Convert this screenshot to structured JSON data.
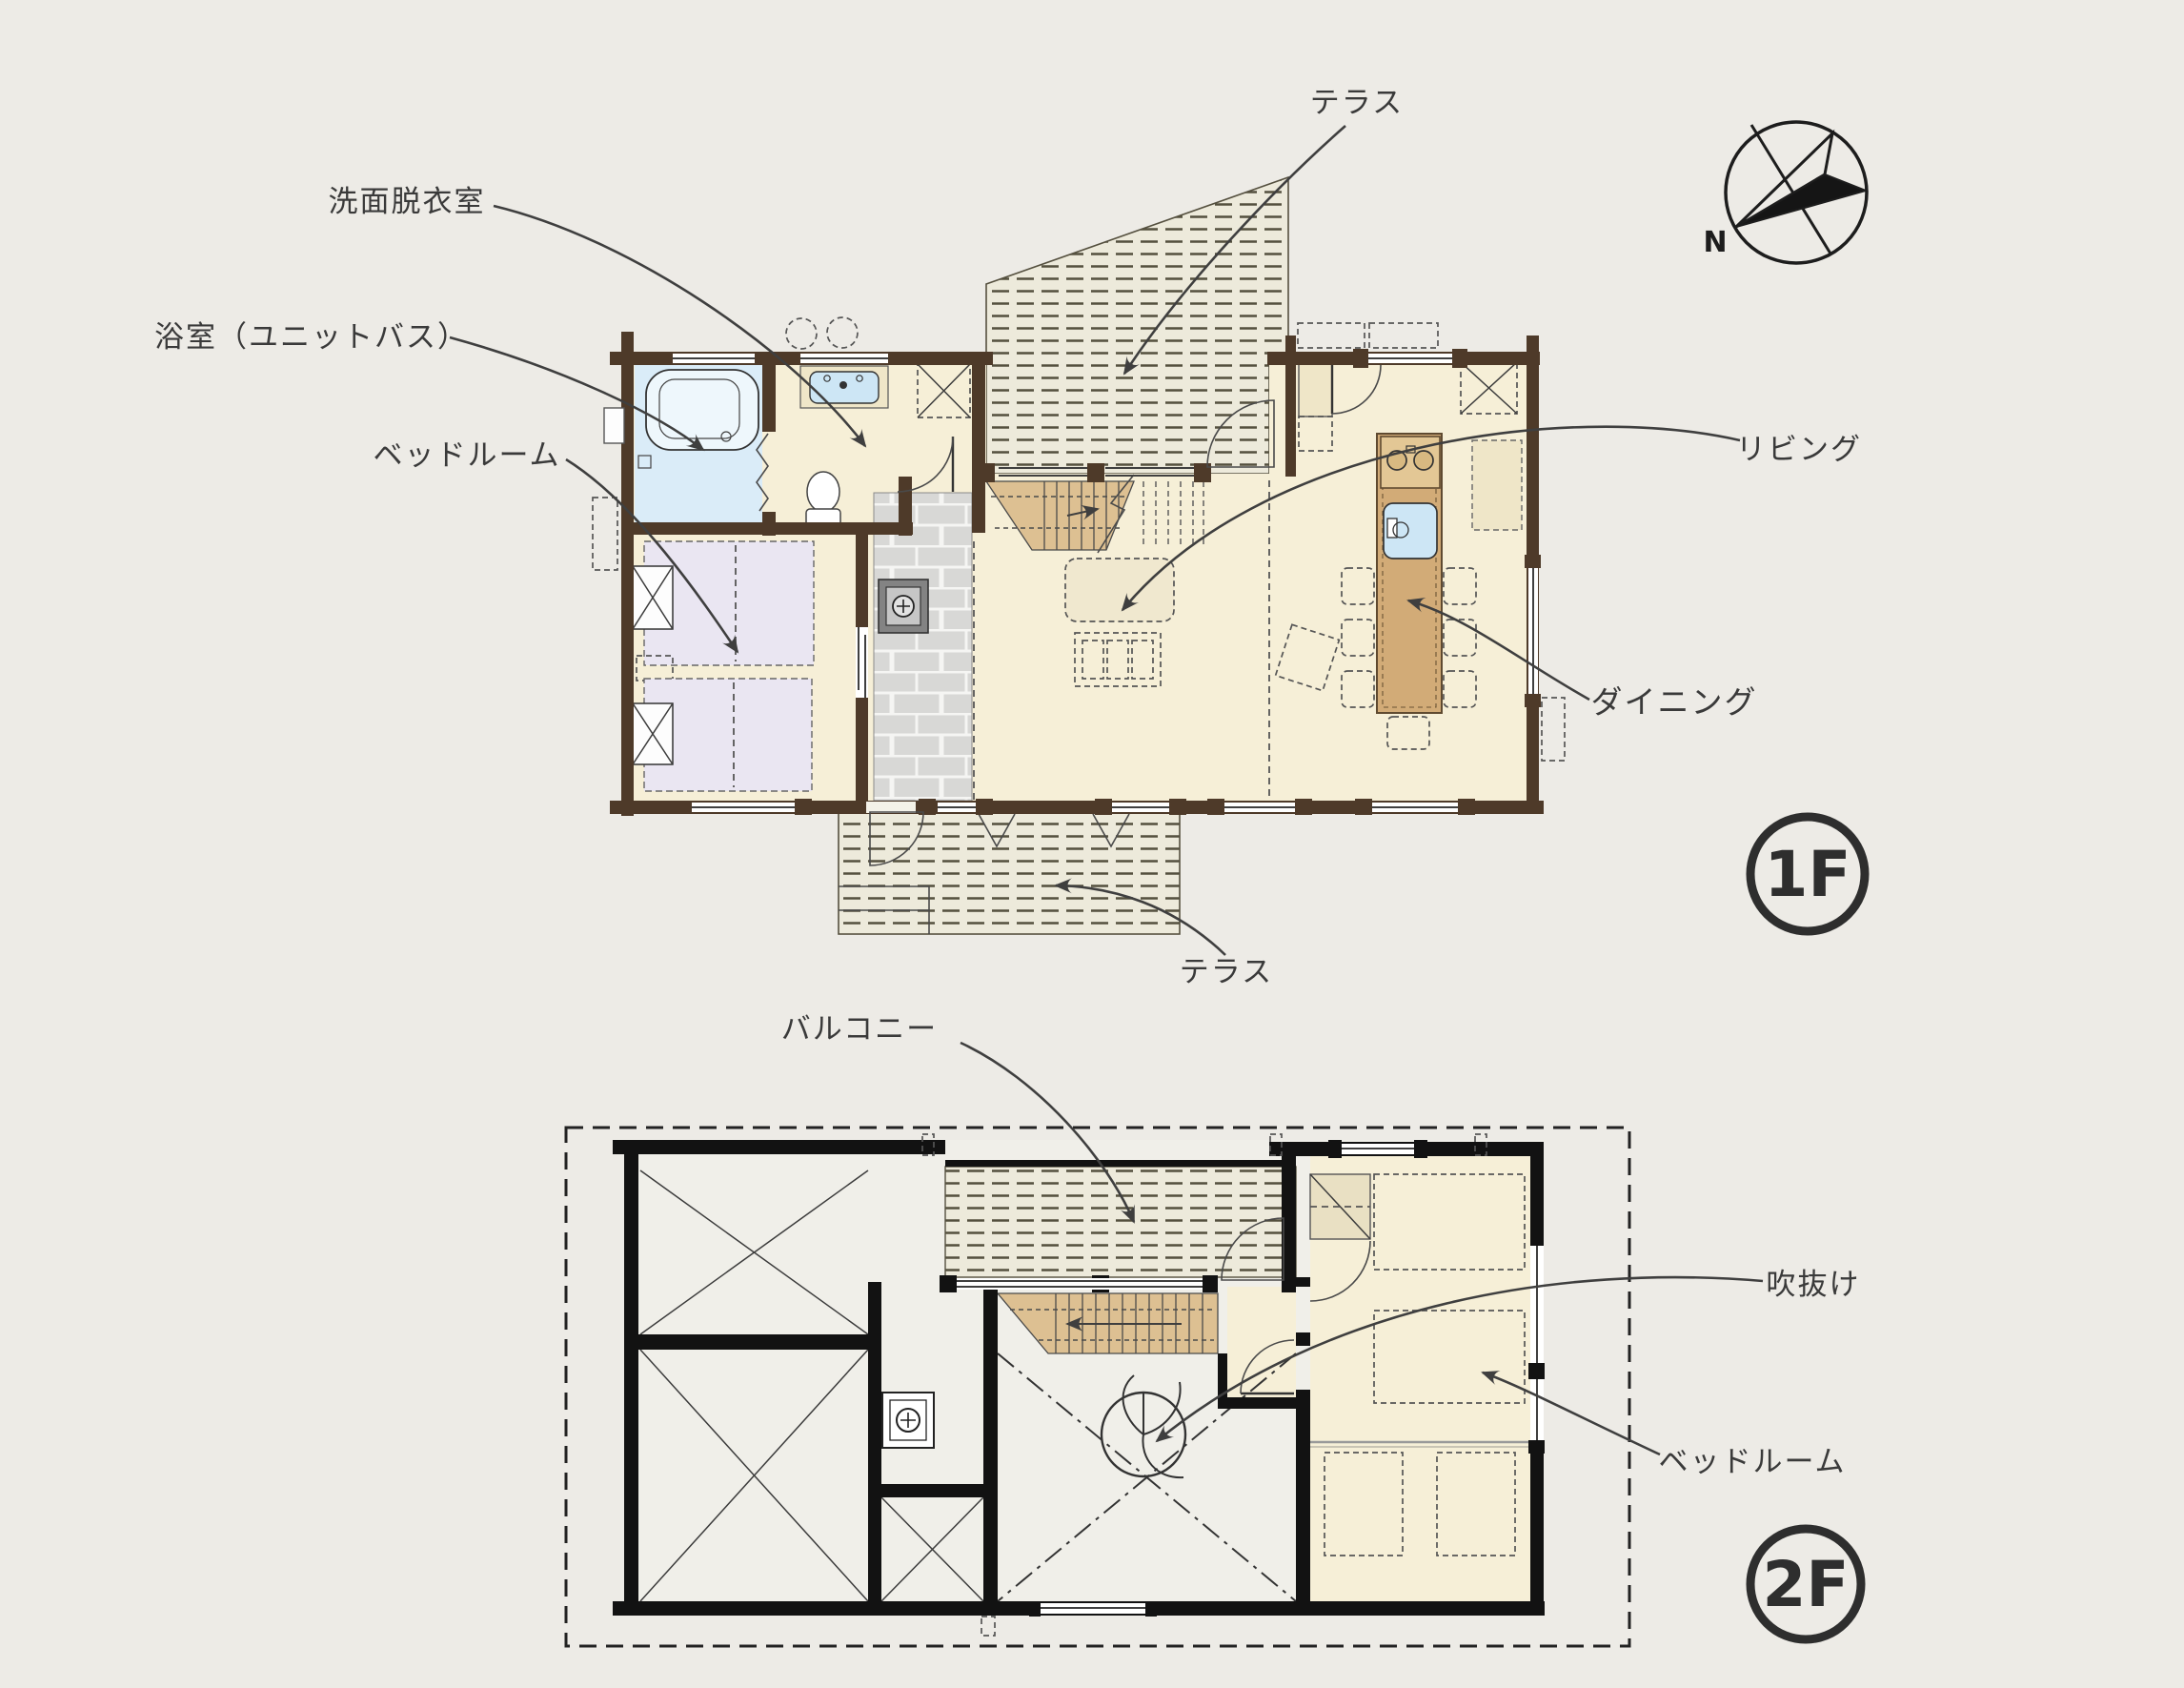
{
  "colors": {
    "background": "#edebe6",
    "ink": "#3a3a3a",
    "wall1": "#4e3a29",
    "wall2": "#121212",
    "floor": "#f6efd7",
    "interior2f": "#f0efe9",
    "bath": "#daecf8",
    "deck": "#edeadb",
    "deckline": "#54503e",
    "tile": "#d8d8d6",
    "stairs": "#ddc092",
    "wood": "#d2ab77",
    "sink": "#cde6f5",
    "linen": "#eae6f2",
    "beige": "#efe6c8"
  },
  "floor1": {
    "badge": "1F",
    "labels": {
      "terrace_top": "テラス",
      "washroom": "洗面脱衣室",
      "bathroom": "浴室（ユニットバス）",
      "bedroom": "ベッドルーム",
      "living": "リビング",
      "dining": "ダイニング",
      "terrace_bottom": "テラス"
    }
  },
  "floor2": {
    "badge": "2F",
    "labels": {
      "balcony": "バルコニー",
      "void": "吹抜け",
      "bedroom": "ベッドルーム"
    }
  },
  "compass": {
    "north": "N"
  },
  "icons": {
    "compass-icon": "circle with half-filled needle pointing toward N (lower-left)",
    "wood-stove-icon": "gray square with crossed circle (1F hall)",
    "flue-icon": "white square with crossed circle (2F)",
    "ceiling-fan-icon": "circle with three curved blades in 2F void",
    "stove-burners-icon": "two circles on kitchen island",
    "crossed-square-icon": "dashed square with X = storage",
    "void-cross-icon": "X across room = open to below"
  }
}
